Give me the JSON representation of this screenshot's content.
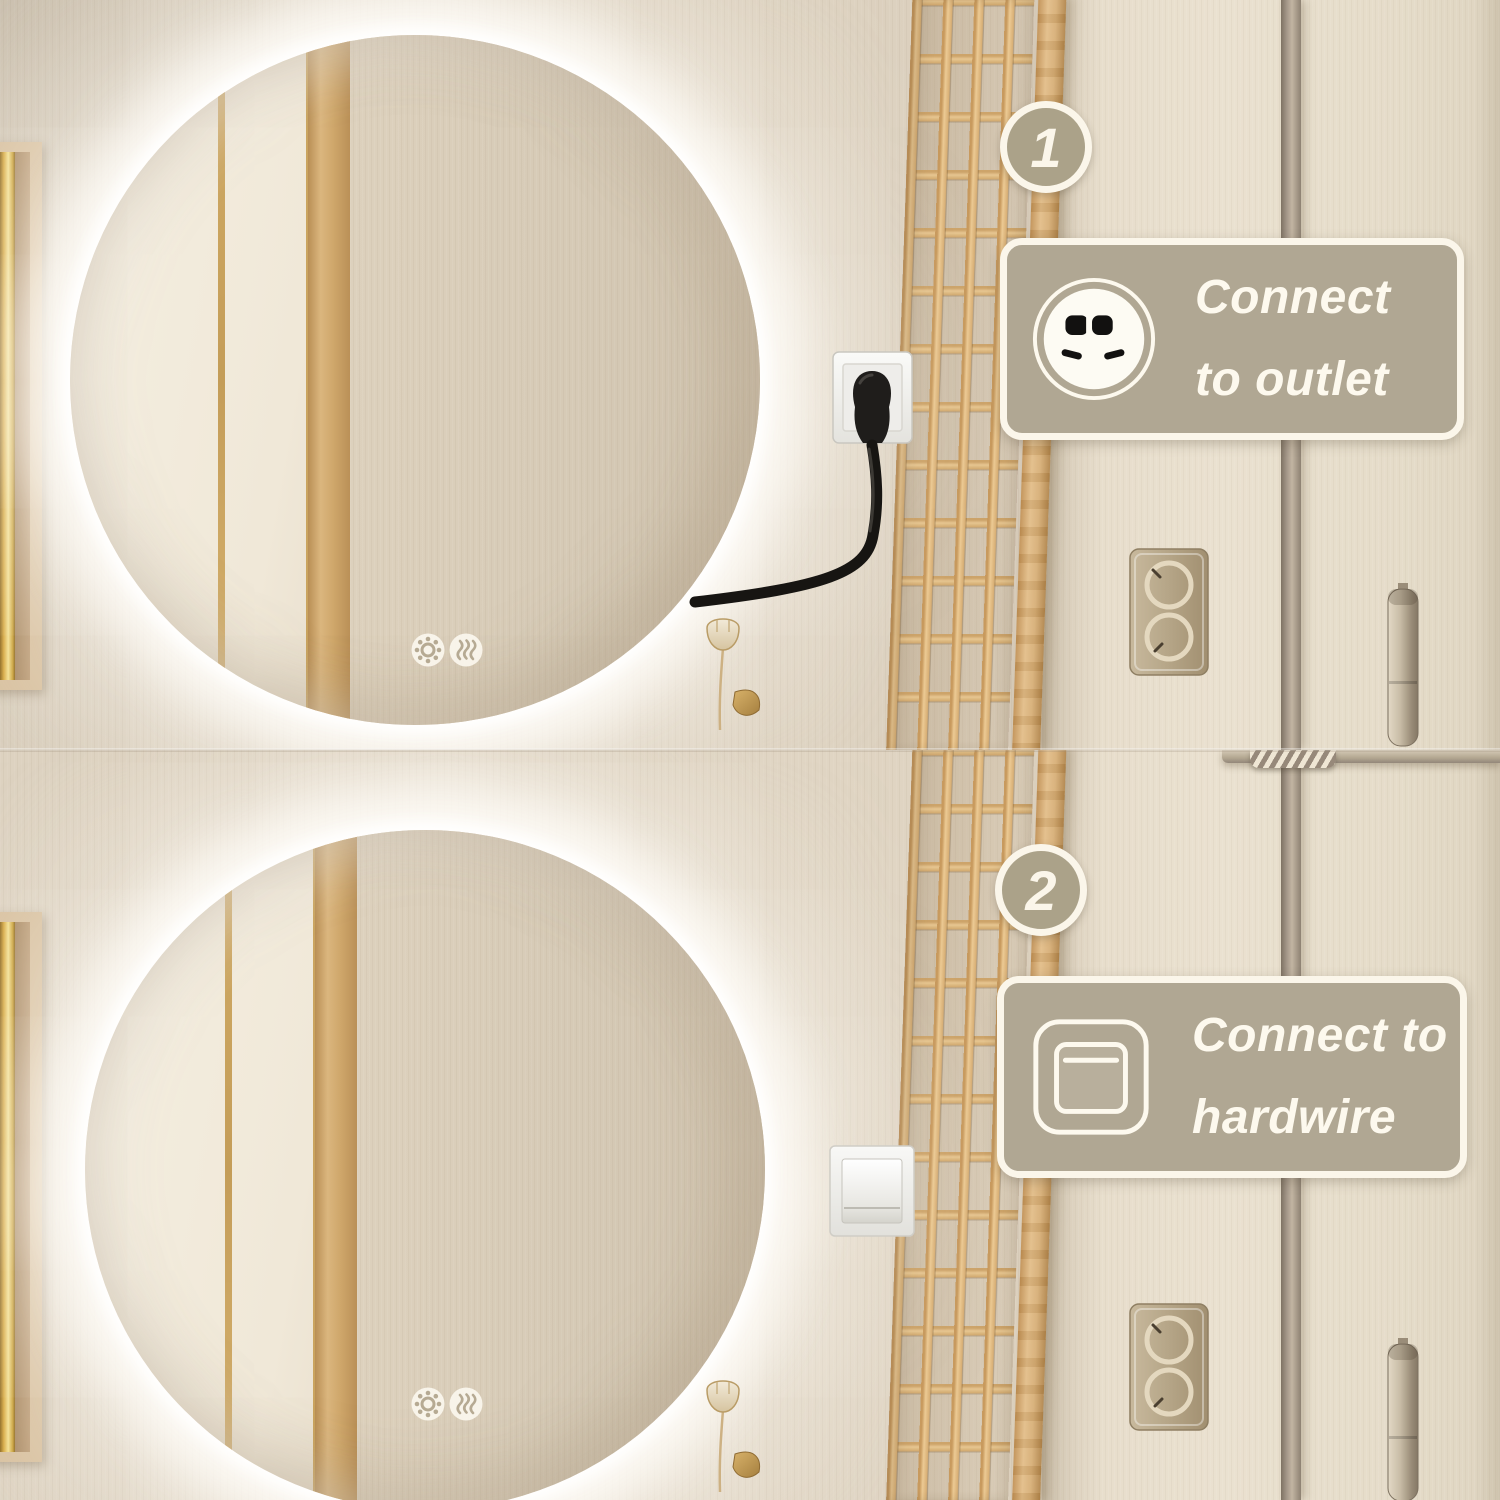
{
  "overlay": {
    "steps": [
      {
        "number": "1",
        "line1": "Connect",
        "line2": "to outlet",
        "icon": "outlet-icon"
      },
      {
        "number": "2",
        "line1": "Connect to",
        "line2": "hardwire",
        "icon": "hardwire-switch-icon"
      }
    ]
  },
  "icons": {
    "step1_label": "outlet-icon",
    "step2_label": "hardwire-switch-icon",
    "mirror_button_left": "light-button-icon",
    "mirror_button_right": "defog-button-icon"
  },
  "colors": {
    "overlay_fill": "#b0a793",
    "badge_fill": "#aba289",
    "overlay_border": "#fbf6ea",
    "wall": "#dcd2c0",
    "wall_right": "#e8dfce",
    "trellis_wood": "#d8af75",
    "plug_cable": "#1b1916",
    "mirror_glow": "#ffffff"
  }
}
